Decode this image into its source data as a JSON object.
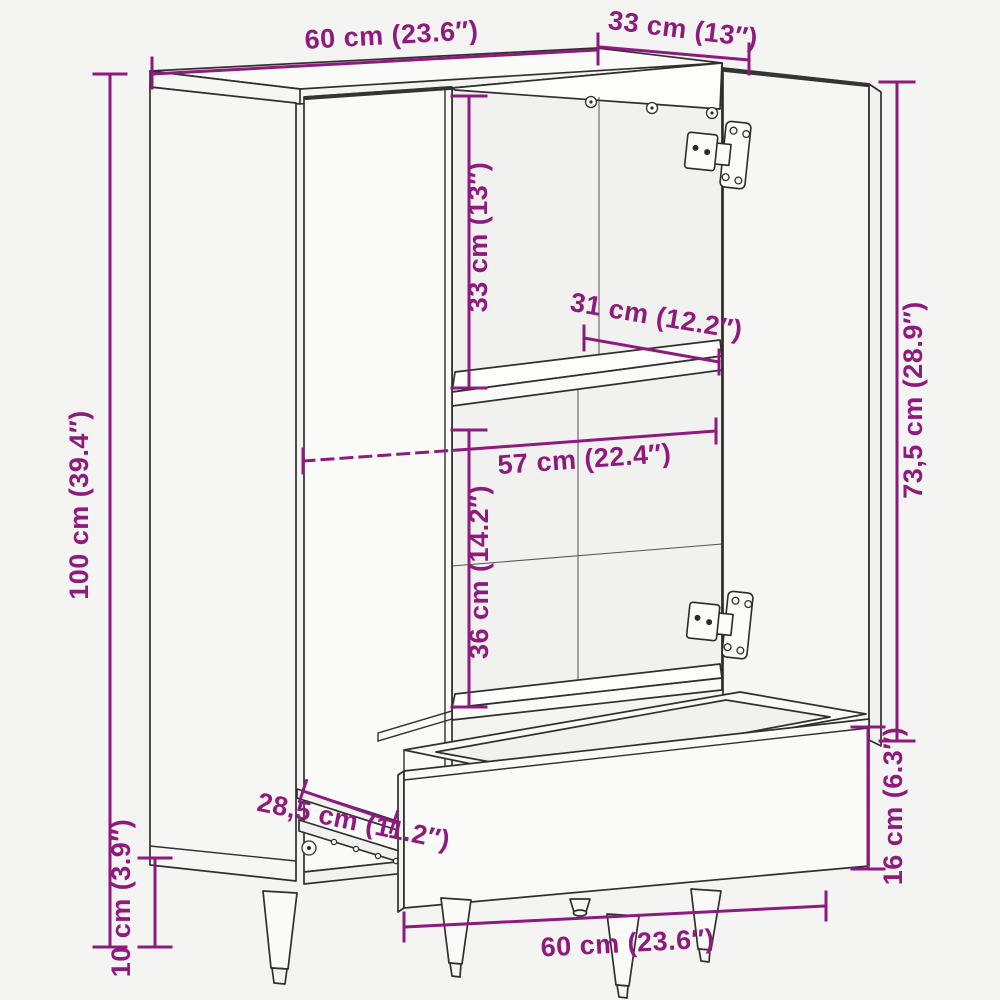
{
  "diagram": {
    "kind": "furniture dimension line drawing",
    "product": "highboard cabinet with two open doors, middle shelf and pulled-out drawer",
    "colors": {
      "dimension_accent": "#8e1a7d",
      "outline": "#2f2f2f",
      "background": "#f4f4f2",
      "surface": "#fafaf9"
    },
    "dimensions": [
      {
        "id": "top-width",
        "label": "60 cm (23.6″)"
      },
      {
        "id": "top-depth",
        "label": "33 cm (13″)"
      },
      {
        "id": "overall-height",
        "label": "100 cm (39.4″)"
      },
      {
        "id": "upper-compartment-height",
        "label": "33 cm (13″)"
      },
      {
        "id": "shelf-depth",
        "label": "31 cm (12.2″)"
      },
      {
        "id": "interior-width",
        "label": "57 cm (22.4″)"
      },
      {
        "id": "lower-compartment-height",
        "label": "36 cm (14.2″)"
      },
      {
        "id": "door-height",
        "label": "73,5 cm (28.9″)"
      },
      {
        "id": "drawer-front-height",
        "label": "16 cm (6.3″)"
      },
      {
        "id": "drawer-slide-depth",
        "label": "28,5 cm (11.2″)"
      },
      {
        "id": "leg-height",
        "label": "10 cm (3.9″)"
      },
      {
        "id": "bottom-width",
        "label": "60 cm (23.6″)"
      }
    ]
  }
}
